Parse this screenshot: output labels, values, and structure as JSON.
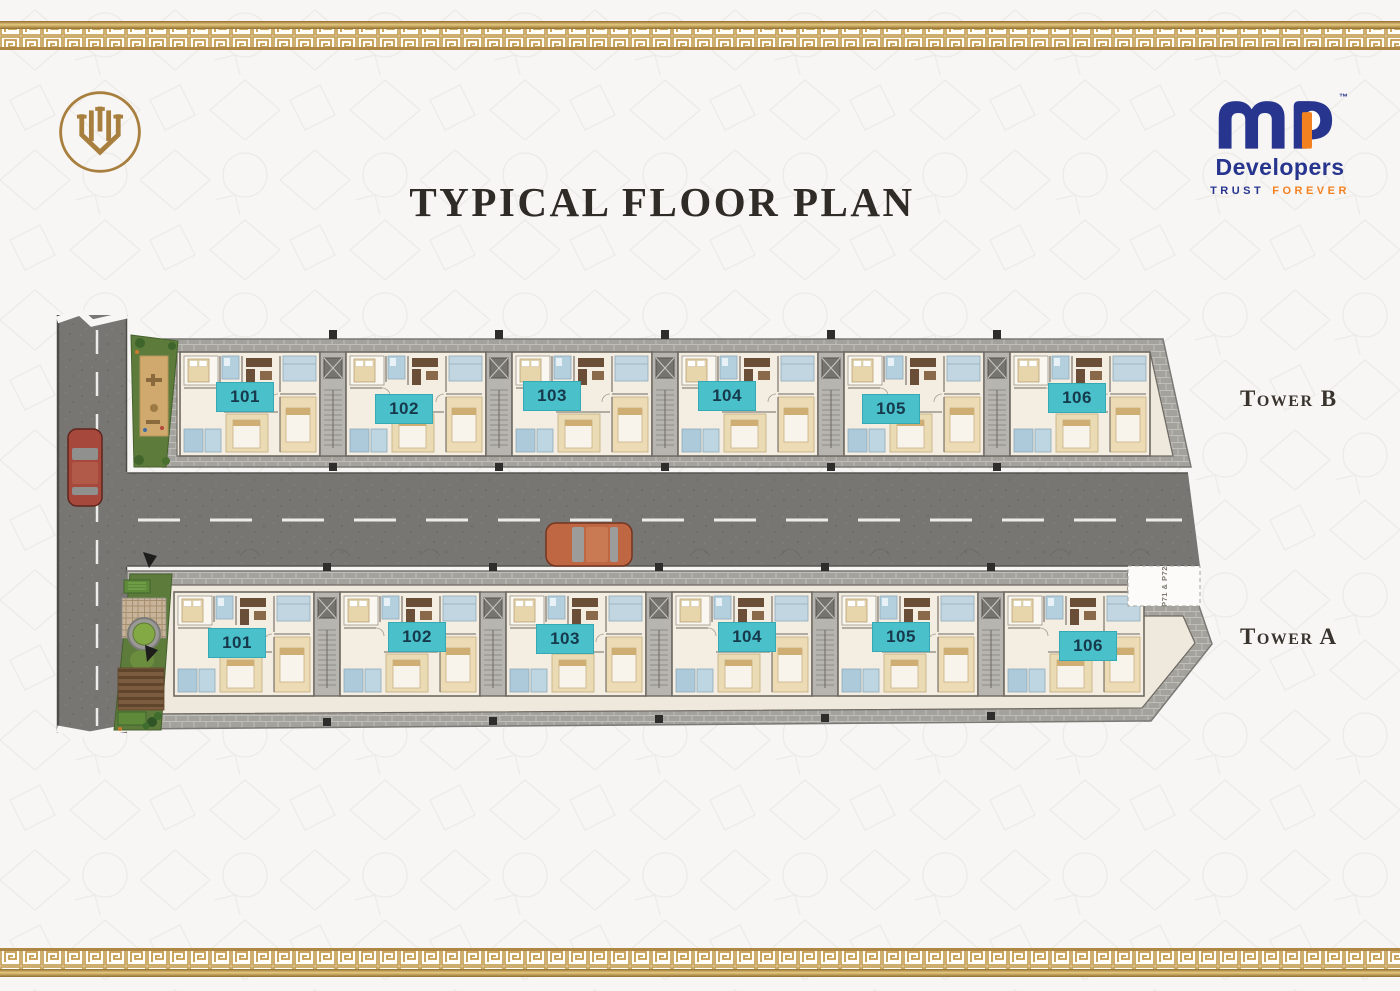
{
  "header": {
    "title": "TYPICAL FLOOR PLAN"
  },
  "brand": {
    "emblem": {
      "label": "gold monogram emblem"
    },
    "mp_logo": {
      "trademark": "™",
      "name": "Developers",
      "tagline_trust": "TRUST",
      "tagline_forever": "FOREVER"
    }
  },
  "plan": {
    "parking_label": "P71 & P72",
    "towers": [
      {
        "id": "tower-b",
        "label": "Tower B",
        "units": [
          "101",
          "102",
          "103",
          "104",
          "105",
          "106"
        ]
      },
      {
        "id": "tower-a",
        "label": "Tower A",
        "units": [
          "101",
          "102",
          "103",
          "104",
          "105",
          "106"
        ]
      }
    ]
  },
  "colors": {
    "badge_teal": "#49c0ca",
    "badge_text": "#16394b",
    "navy": "#27358e",
    "orange": "#f48120",
    "gold": "#b9924d"
  }
}
